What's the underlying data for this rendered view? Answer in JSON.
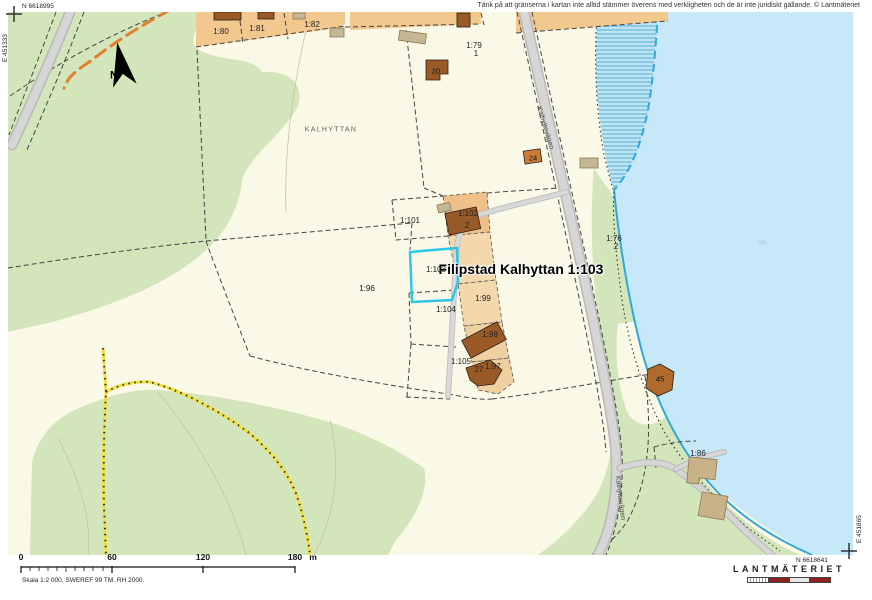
{
  "disclaimer": "Tänk på att gränserna i kartan inte alltid stämmer överens med verkligheten och de är inte juridiskt gällande. © Lantmäteriet",
  "corners": {
    "nw_n": "N 6618995",
    "nw_e": "E 451333",
    "se_n": "N 6618641",
    "se_e": "E 451865"
  },
  "scalebar": {
    "ticks": [
      "0",
      "60",
      "120",
      "180"
    ],
    "unit": "m",
    "caption": "Skala 1:2 000. SWEREF 99 TM. RH 2000."
  },
  "logo": {
    "text": "LANTMÄTERIET"
  },
  "colors": {
    "land": "#faf8e6",
    "forest": "#d3e5ba",
    "water": "#c7e8f9",
    "shoreline": "#2fa8e0",
    "selection": "#2cc7e8",
    "parcel_tan": "#f2c88f",
    "building_brown": "#9a5a28",
    "road_gray": "#d6d6d6",
    "trail_yellow": "#f0e040",
    "path_orange": "#e0802f"
  },
  "map_labels": [
    {
      "t": "KALHYTTAN",
      "x": 331,
      "y": 130,
      "c": "place"
    },
    {
      "t": "Filipstad Kalhyttan 1:103",
      "x": 521,
      "y": 269,
      "c": "highlight"
    },
    {
      "t": "1:80",
      "x": 221,
      "y": 32,
      "c": "parcel"
    },
    {
      "t": "1:81",
      "x": 257,
      "y": 29,
      "c": "parcel"
    },
    {
      "t": "1:82",
      "x": 312,
      "y": 25,
      "c": "parcel"
    },
    {
      "t": "1:79",
      "x": 474,
      "y": 46,
      "c": "parcel"
    },
    {
      "t": "1",
      "x": 476,
      "y": 54,
      "c": "parcel"
    },
    {
      "t": "20",
      "x": 436,
      "y": 71,
      "c": "bnum"
    },
    {
      "t": "24",
      "x": 533,
      "y": 158,
      "c": "bnum"
    },
    {
      "t": "1:101",
      "x": 410,
      "y": 221,
      "c": "parcel"
    },
    {
      "t": "1:102",
      "x": 468,
      "y": 214,
      "c": "parcel"
    },
    {
      "t": "2",
      "x": 467,
      "y": 226,
      "c": "parcel"
    },
    {
      "t": "1:103",
      "x": 436,
      "y": 270,
      "c": "parcel"
    },
    {
      "t": "1:96",
      "x": 367,
      "y": 289,
      "c": "parcel"
    },
    {
      "t": "1:99",
      "x": 483,
      "y": 299,
      "c": "parcel"
    },
    {
      "t": "1:104",
      "x": 446,
      "y": 310,
      "c": "parcel"
    },
    {
      "t": "1:105",
      "x": 461,
      "y": 362,
      "c": "parcel"
    },
    {
      "t": "1:98",
      "x": 490,
      "y": 335,
      "c": "parcel"
    },
    {
      "t": "27",
      "x": 479,
      "y": 370,
      "c": "parcel"
    },
    {
      "t": "1:97",
      "x": 493,
      "y": 367,
      "c": "parcel"
    },
    {
      "t": "1:76",
      "x": 614,
      "y": 239,
      "c": "parcel"
    },
    {
      "t": "2",
      "x": 616,
      "y": 247,
      "c": "parcel"
    },
    {
      "t": "45",
      "x": 660,
      "y": 379,
      "c": "bnum"
    },
    {
      "t": "1:86",
      "x": 698,
      "y": 454,
      "c": "parcel"
    },
    {
      "t": "105",
      "x": 762,
      "y": 244,
      "c": "water-label"
    },
    {
      "t": "Kalhyttevägen",
      "x": 545,
      "y": 128,
      "c": "road",
      "r": 73
    },
    {
      "t": "Kalhyttevägen",
      "x": 620,
      "y": 498,
      "c": "road",
      "r": 83
    },
    {
      "t": "N",
      "x": 114,
      "y": 76,
      "c": "north-n"
    }
  ]
}
